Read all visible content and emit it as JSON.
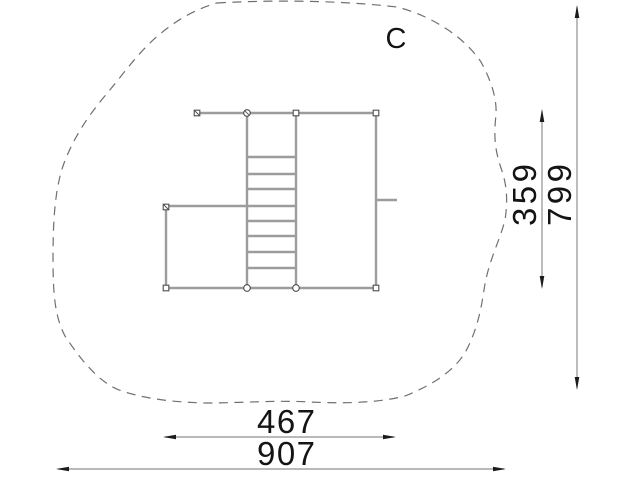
{
  "drawing": {
    "labels": {
      "zone": "C"
    },
    "dimensions": {
      "structure_width": "467",
      "zone_width": "907",
      "structure_depth": "359",
      "zone_depth": "799"
    },
    "colors": {
      "background": "#ffffff",
      "structure_line": "#9c9c9c",
      "marker_stroke": "#4d4d4d",
      "dashed_outline": "#707070",
      "dimension_line": "#8f8f8f",
      "arrowhead": "#1c1c1c",
      "text": "#141414"
    }
  }
}
